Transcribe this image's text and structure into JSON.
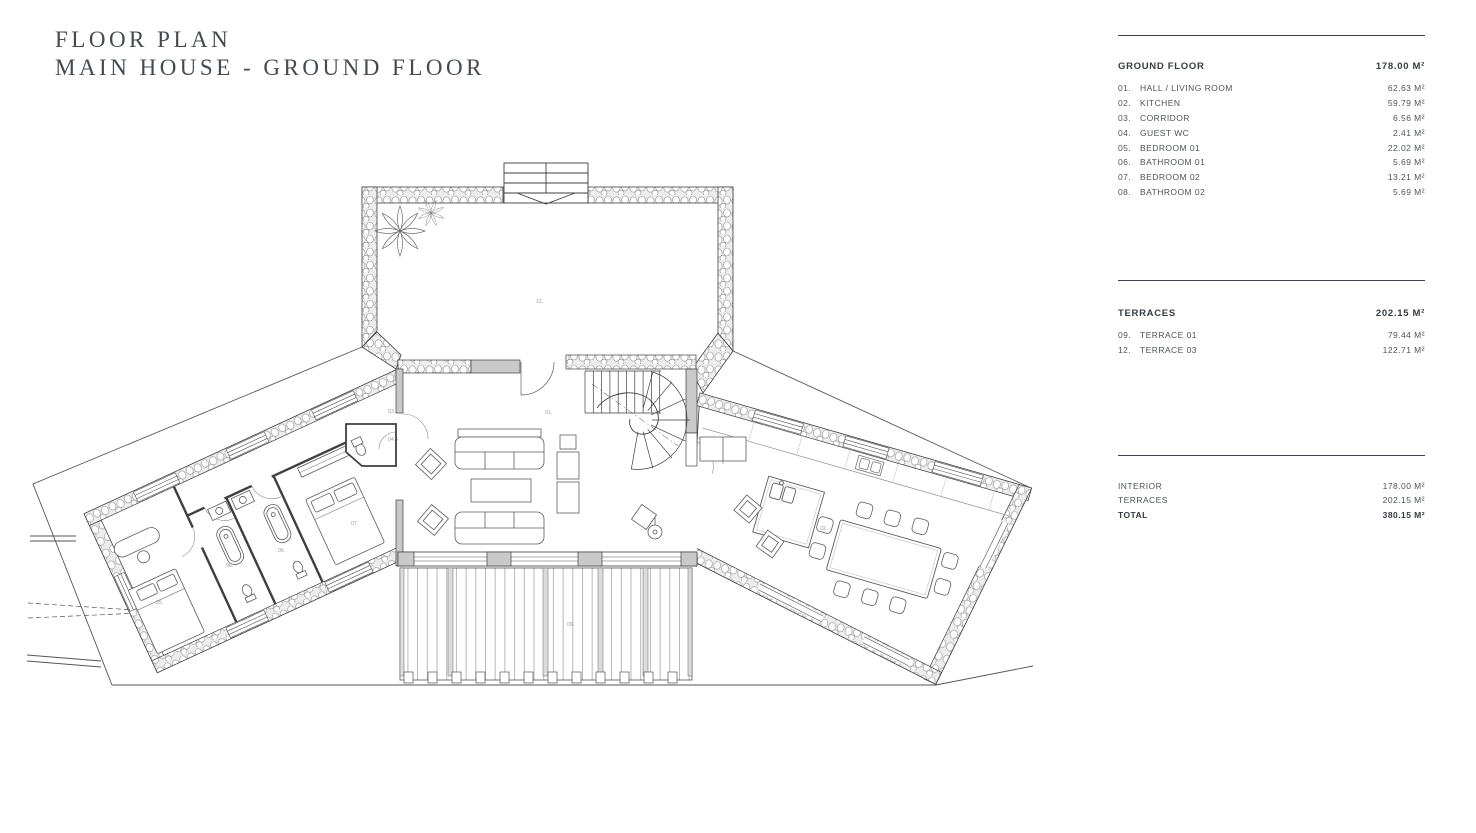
{
  "title": {
    "line1": "FLOOR PLAN",
    "line2": "MAIN HOUSE - GROUND FLOOR"
  },
  "panel": {
    "ground_floor": {
      "label": "GROUND FLOOR",
      "total": "178.00 M²",
      "rows": [
        {
          "num": "01.",
          "label": "HALL / LIVING ROOM",
          "value": "62.63 M²"
        },
        {
          "num": "02.",
          "label": "KITCHEN",
          "value": "59.79 M²"
        },
        {
          "num": "03.",
          "label": "CORRIDOR",
          "value": "6.56 M²"
        },
        {
          "num": "04.",
          "label": "GUEST WC",
          "value": "2.41 M²"
        },
        {
          "num": "05.",
          "label": "BEDROOM 01",
          "value": "22.02 M²"
        },
        {
          "num": "06.",
          "label": "BATHROOM 01",
          "value": "5.69 M²"
        },
        {
          "num": "07.",
          "label": "BEDROOM 02",
          "value": "13.21 M²"
        },
        {
          "num": "08.",
          "label": "BATHROOM 02",
          "value": "5.69 M²"
        }
      ]
    },
    "terraces": {
      "label": "TERRACES",
      "total": "202.15 M²",
      "rows": [
        {
          "num": "09.",
          "label": "TERRACE 01",
          "value": "79.44 M²"
        },
        {
          "num": "12.",
          "label": "TERRACE 03",
          "value": "122.71 M²"
        }
      ]
    },
    "summary": {
      "rows": [
        {
          "label": "INTERIOR",
          "value": "178.00 M²"
        },
        {
          "label": "TERRACES",
          "value": "202.15 M²"
        }
      ],
      "total_label": "TOTAL",
      "total_value": "380.15 M²"
    }
  },
  "plan": {
    "labels": {
      "hall": "01.",
      "kitchen": "02.",
      "corridor": "03.",
      "guest_wc": "04.",
      "bedroom01": "05.",
      "bathroom01": "06.",
      "bedroom02": "07.",
      "bathroom02": "08.",
      "terrace01": "09.",
      "terrace03": "12."
    }
  },
  "colors": {
    "ink": "#3f3f3f",
    "wall_gray": "#c9c9c9",
    "text_dark": "#3c4247",
    "label_gray": "#9b9b9b"
  }
}
